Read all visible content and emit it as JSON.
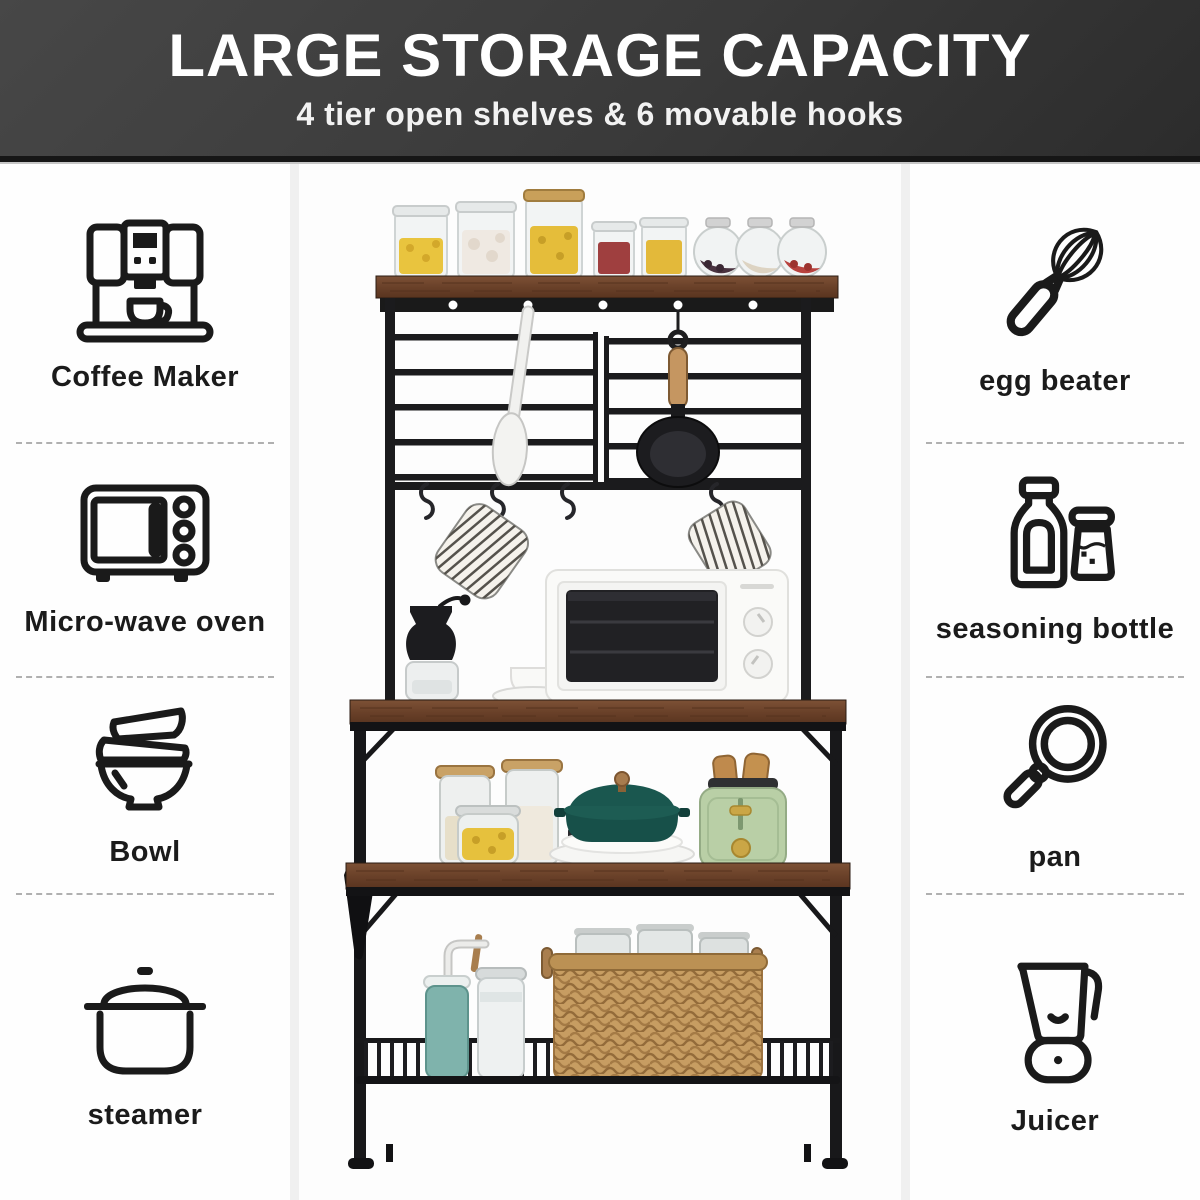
{
  "header": {
    "title": "LARGE STORAGE CAPACITY",
    "subtitle": "4 tier open shelves & 6 movable hooks"
  },
  "features": {
    "left": [
      {
        "icon": "coffee-maker-icon",
        "label": "Coffee Maker"
      },
      {
        "icon": "microwave-icon",
        "label": "Micro-wave oven"
      },
      {
        "icon": "bowl-icon",
        "label": "Bowl"
      },
      {
        "icon": "steamer-icon",
        "label": "steamer"
      }
    ],
    "right": [
      {
        "icon": "egg-beater-icon",
        "label": "egg beater"
      },
      {
        "icon": "seasoning-bottle-icon",
        "label": "seasoning bottle"
      },
      {
        "icon": "pan-icon",
        "label": "pan"
      },
      {
        "icon": "juicer-icon",
        "label": "Juicer"
      }
    ]
  },
  "photo": {
    "shelves_count": "4",
    "hooks_count": "6"
  },
  "colors": {
    "header_bg": "#3a3a3a",
    "header_text": "#ffffff",
    "icon_stroke": "#1a1a1a",
    "divider_dash": "#b0b0b0",
    "frame_black": "#1b1b1d",
    "shelf_wood": "#6a4129",
    "dutch_oven_teal": "#175049",
    "toaster_green": "#b9cfa6",
    "basket_tan": "#c79d62",
    "mason_jar_teal": "#7fb3ac"
  }
}
